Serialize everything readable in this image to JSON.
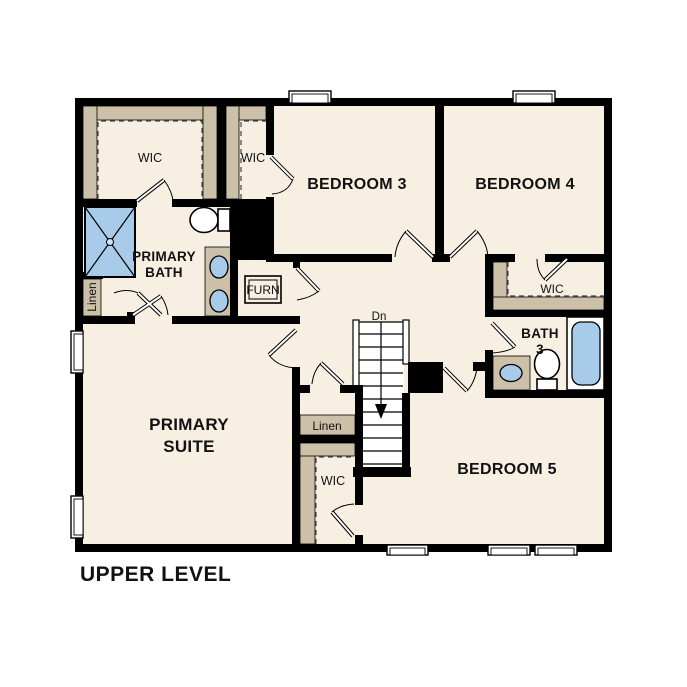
{
  "title": "UPPER LEVEL",
  "colors": {
    "floor": "#f7f0e2",
    "shelf": "#cdc0a8",
    "fixture_blue": "#a8cbe9",
    "wall": "#000000",
    "background": "#ffffff"
  },
  "labels": {
    "wic_top_left": "WIC",
    "wic_top_mid": "WIC",
    "wic_right": "WIC",
    "wic_bottom": "WIC",
    "bedroom3": "BEDROOM 3",
    "bedroom4": "BEDROOM 4",
    "bedroom5": "BEDROOM 5",
    "primary_bath_line1": "PRIMARY",
    "primary_bath_line2": "BATH",
    "primary_suite_line1": "PRIMARY",
    "primary_suite_line2": "SUITE",
    "bath3_line1": "BATH",
    "bath3_line2": "3",
    "linen_left": "Linen",
    "linen_center": "Linen",
    "furnace": "FURN",
    "stairs_down": "Dn"
  }
}
